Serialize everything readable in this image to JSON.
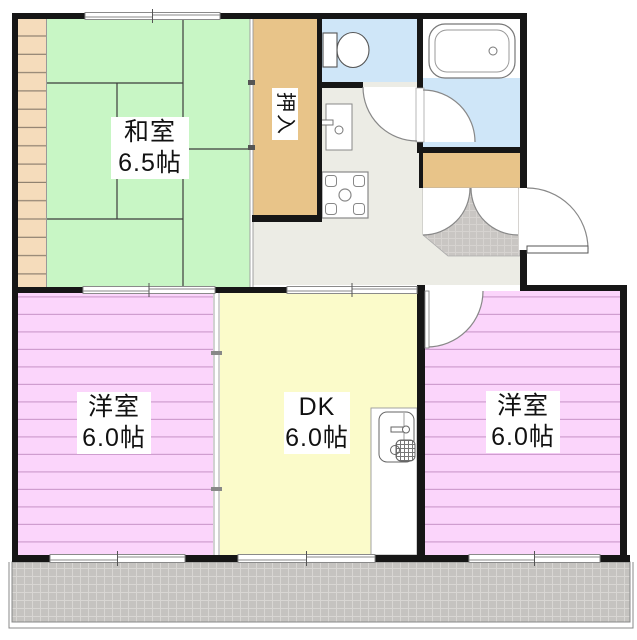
{
  "plan_title": "2DK apartment floor plan",
  "rooms": {
    "washitsu": {
      "name": "和室",
      "size": "6.5帖"
    },
    "oshiire": {
      "name": "押入"
    },
    "youshitsu_left": {
      "name": "洋室",
      "size": "6.0帖"
    },
    "dk": {
      "name": "DK",
      "size": "6.0帖"
    },
    "youshitsu_right": {
      "name": "洋室",
      "size": "6.0帖"
    }
  },
  "fixtures": [
    "toilet",
    "bathtub",
    "washbasin",
    "washing-machine-pan",
    "kitchen-sink",
    "shoe-closet",
    "entrance-door",
    "balcony"
  ],
  "colors": {
    "wall": "#161616",
    "tatami_green": "#c8f6c5",
    "closet_tan": "#e8c489",
    "veranda_tan": "#f5dcbb",
    "water_blue": "#cfe6f8",
    "hall_gray": "#ecece5",
    "dk_yellow": "#fbfbca",
    "room_pink": "#fbd5fb",
    "pink_stripe": "#cf9dcf",
    "balcony_gray": "#c5c3c0"
  }
}
